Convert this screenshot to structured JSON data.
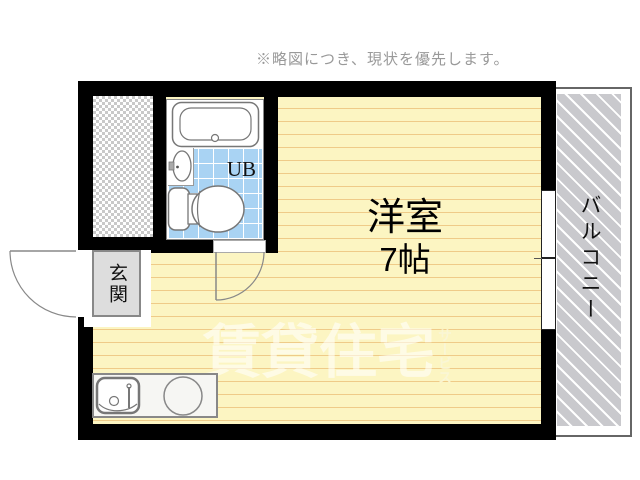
{
  "note": {
    "text": "※略図につき、現状を優先します。"
  },
  "rooms": {
    "main_room": {
      "name": "洋室",
      "size": "7帖"
    },
    "unit_bath": {
      "label": "UB"
    },
    "entrance": {
      "label": "玄関"
    },
    "balcony": {
      "label": "バルコニー"
    }
  },
  "watermark": {
    "text": "賃貸住宅",
    "suffix": "サービス"
  },
  "colors": {
    "floor": "#FCF5C2",
    "floor_line": "#EFCB88",
    "tile_blue": "#A9D3F3",
    "wall": "#000000",
    "balcony_hatch": "#C9C9CD",
    "genkan_gray": "#DDDDDD",
    "note_text": "#999999",
    "fixture_outline": "#777777"
  }
}
